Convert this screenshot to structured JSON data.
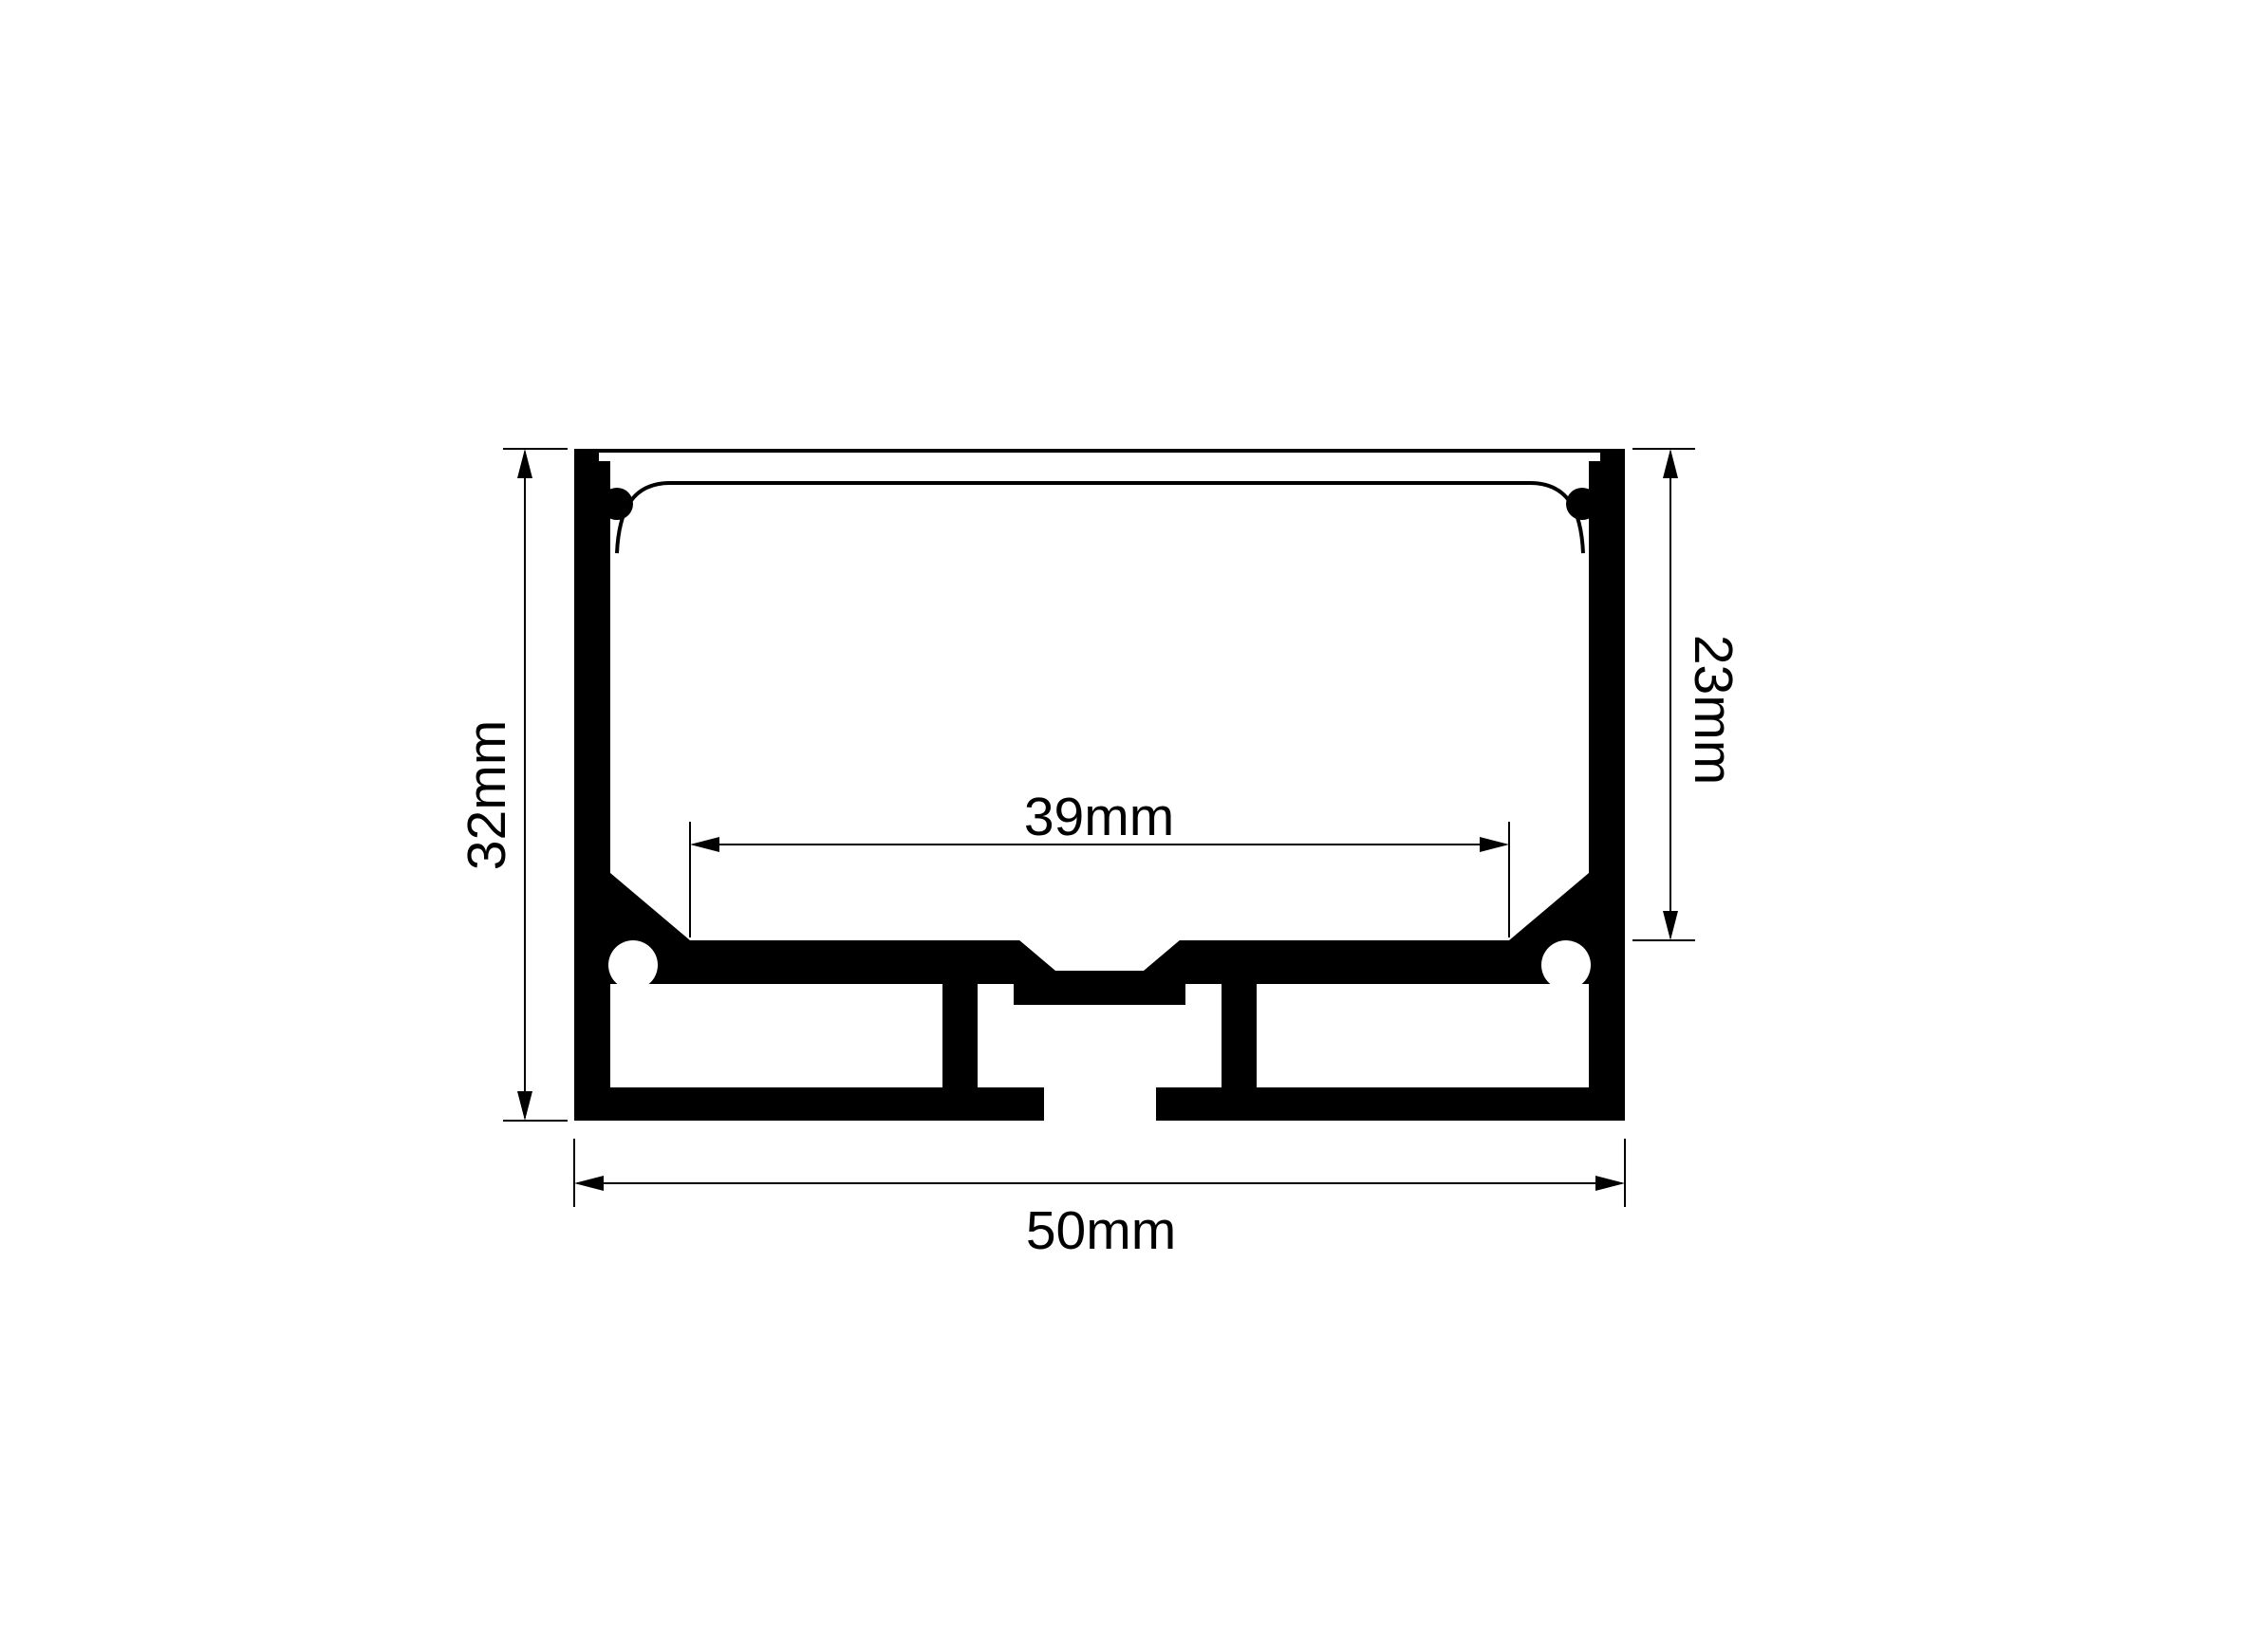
{
  "drawing": {
    "type": "technical-cross-section",
    "subject": "aluminium LED strip profile cross-section with dimension annotations",
    "background_color": "#ffffff",
    "line_color": "#000000",
    "labels": {
      "overall_height": "32mm",
      "inner_depth": "23mm",
      "inner_width": "39mm",
      "overall_width": "50mm"
    }
  }
}
